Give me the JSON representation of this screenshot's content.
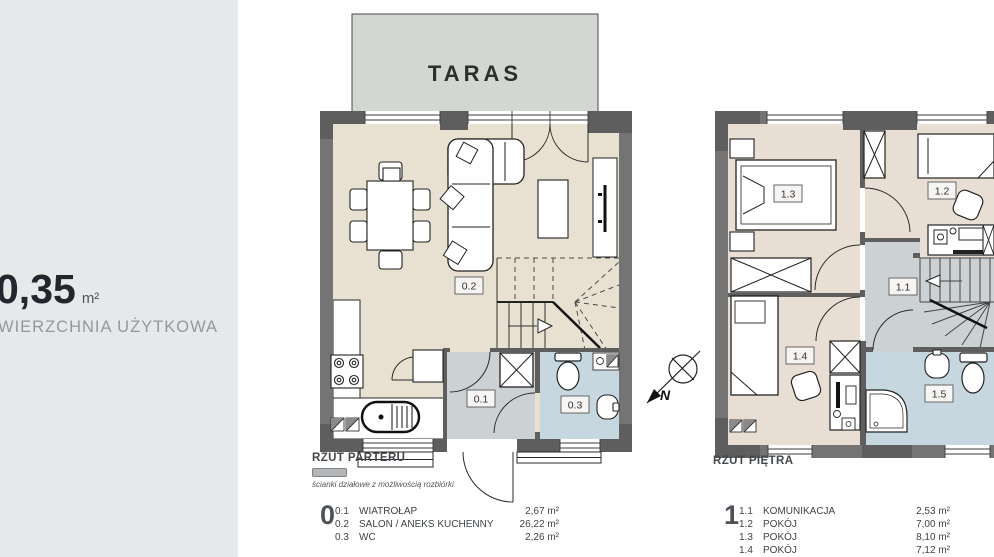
{
  "left_panel": {
    "area_value": "0,35",
    "area_unit": "m²",
    "area_caption": "WIERZCHNIA UŻYTKOWA"
  },
  "terrace": {
    "label": "TARAS"
  },
  "compass": {
    "north": "N"
  },
  "ground_floor": {
    "title": "RZUT PARTERU",
    "legend_note": "ścianki działowe z możliwością rozbiórki",
    "level": "0",
    "labels": {
      "r01": "0.1",
      "r02": "0.2",
      "r03": "0.3"
    },
    "rooms": [
      {
        "code": "0.1",
        "name": "WIATROŁAP",
        "area": "2,67 m²"
      },
      {
        "code": "0.2",
        "name": "SALON / ANEKS KUCHENNY",
        "area": "26,22 m²"
      },
      {
        "code": "0.3",
        "name": "WC",
        "area": "2,26 m²"
      }
    ]
  },
  "upper_floor": {
    "title": "RZUT PIĘTRA",
    "level": "1",
    "labels": {
      "r11": "1.1",
      "r12": "1.2",
      "r13": "1.3",
      "r14": "1.4",
      "r15": "1.5"
    },
    "rooms": [
      {
        "code": "1.1",
        "name": "KOMUNIKACJA",
        "area": "2,53 m²"
      },
      {
        "code": "1.2",
        "name": "POKÓJ",
        "area": "7,00 m²"
      },
      {
        "code": "1.3",
        "name": "POKÓJ",
        "area": "8,10 m²"
      },
      {
        "code": "1.4",
        "name": "POKÓJ",
        "area": "7,12 m²"
      }
    ]
  },
  "colors": {
    "panel_bg": "#e6e8e9",
    "wall": "#747474",
    "wall_dark": "#5e5e5e",
    "floor_ground": "#e8e0d0",
    "floor_upper": "#e9ded4",
    "floor_hall": "#ccd1d4",
    "floor_bath": "#c6d7e0",
    "terrace": "#d3d7d2"
  }
}
